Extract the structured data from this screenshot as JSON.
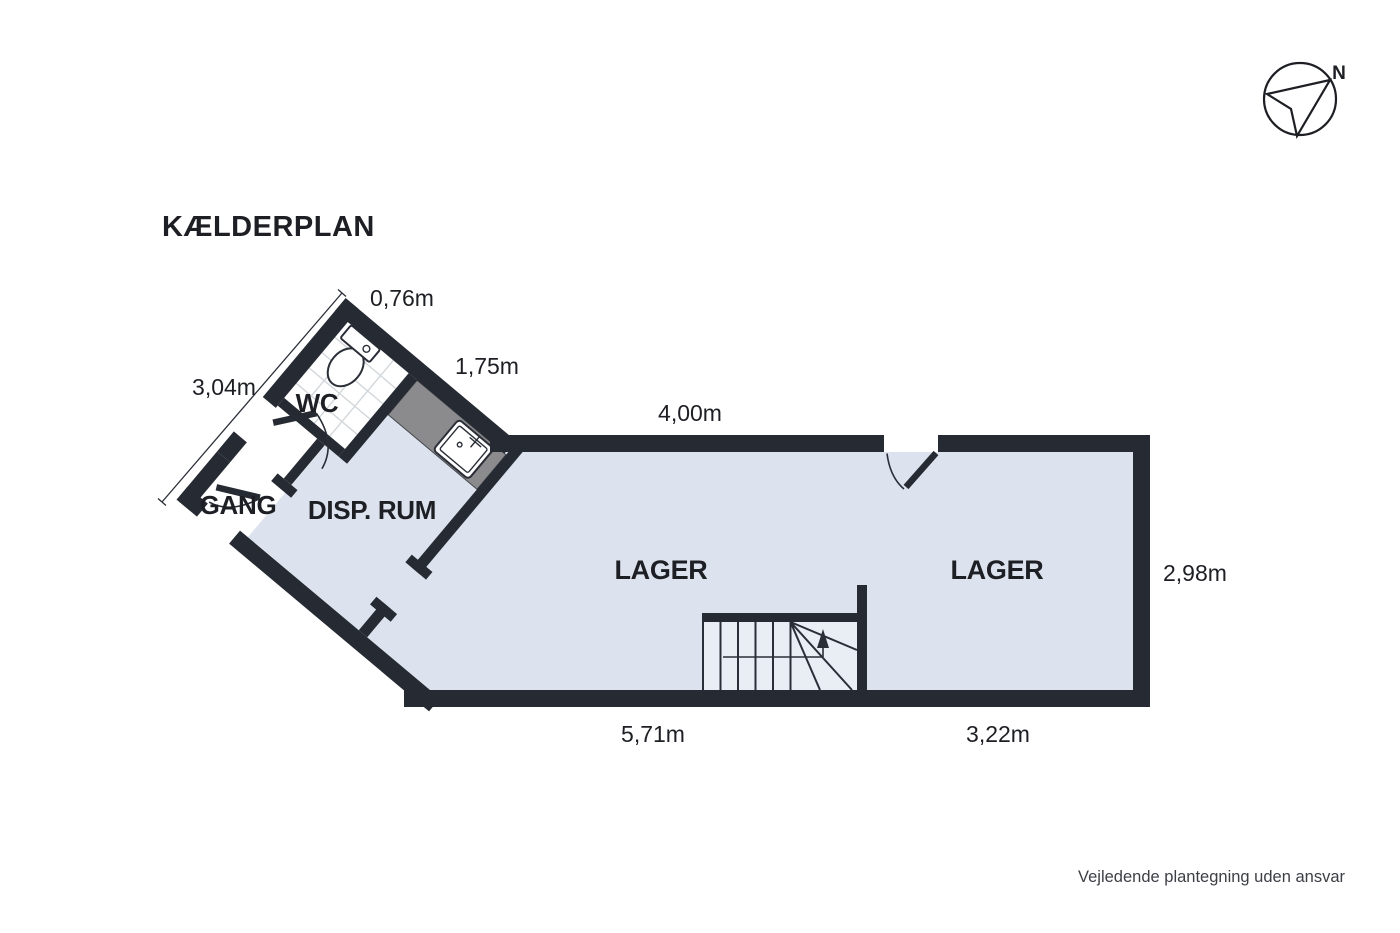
{
  "title": "KÆLDERPLAN",
  "compass": {
    "north_label": "N"
  },
  "rooms": {
    "wc": "WC",
    "gang": "GANG",
    "disp_rum": "DISP. RUM",
    "lager_left": "LAGER",
    "lager_right": "LAGER"
  },
  "dimensions": {
    "wc_top_edge": "0,76m",
    "counter_edge": "1,75m",
    "northwest_edge": "3,04m",
    "lager_top": "4,00m",
    "lager_right_height": "2,98m",
    "lager_bottom_left": "5,71m",
    "lager_bottom_right": "3,22m"
  },
  "footer": {
    "disclaimer": "Vejledende plantegning uden ansvar"
  },
  "colors": {
    "wall": "#262b33",
    "floor": "#dde3ee",
    "stair-floor": "#e9edf4",
    "counter": "#8b8b8e",
    "counter-border": "#44474d",
    "tile": "#d2d7db",
    "line": "#2a2e37",
    "text-dark": "#1d1f24",
    "footer-text": "#3d3f45",
    "white": "#ffffff",
    "bg": "#ffffff"
  }
}
